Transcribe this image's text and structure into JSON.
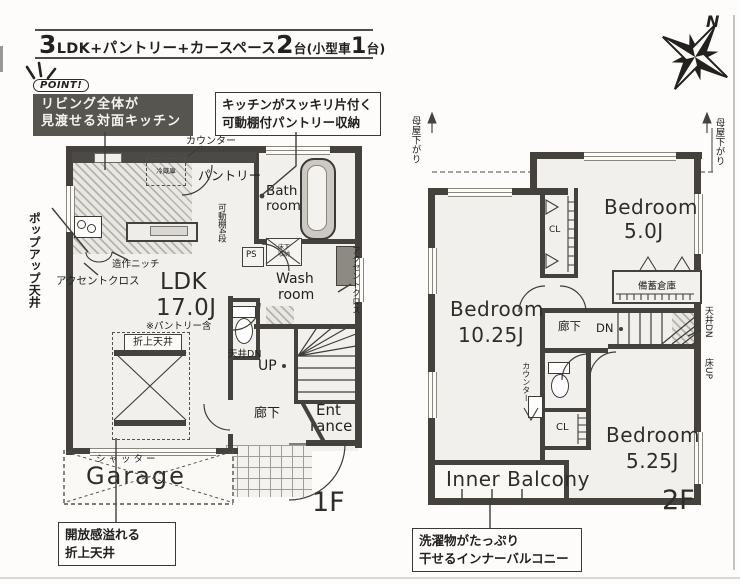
{
  "title": {
    "segments": [
      {
        "t": "3"
      },
      {
        "t": "LDK"
      },
      {
        "t": " +パントリー+カースペース"
      },
      {
        "t": "2"
      },
      {
        "t": "台"
      },
      {
        "t": "(小型車"
      },
      {
        "t": "1"
      },
      {
        "t": "台)"
      }
    ]
  },
  "point": {
    "badge": "POINT!",
    "line1": "リビング全体が",
    "line2": "見渡せる対面キッチン"
  },
  "callouts": {
    "pantry": {
      "line1": "キッチンがスッキリ片付く",
      "line2": "可動棚付パントリー収納"
    },
    "ceiling": {
      "line1": "開放感溢れる",
      "line2": "折上天井"
    },
    "balcony": {
      "line1": "洗濯物がたっぷり",
      "line2": "干せるインナーバルコニー"
    }
  },
  "compass": {
    "north": "N"
  },
  "floor1": {
    "label": "1F",
    "counter": "カウンター",
    "pantry": "パントリー",
    "bath_l1": "Bath",
    "bath_l2": "room",
    "shelf": "可動棚4段",
    "underfloor_l1": "床下",
    "underfloor_l2": "収納",
    "ps": "PS",
    "wash_l1": "Wash",
    "wash_l2": "room",
    "accent_right": "アクセントクロス",
    "popup": "ポップアップ天井",
    "niche": "造作ニッチ",
    "accent_left": "アクセントクロス",
    "ldk": "LDK",
    "ldk_size": "17.0J",
    "ldk_note": "※パントリー含",
    "fridge": "冷蔵庫",
    "orikami": "折上天井",
    "ceiling_dn": "天井DN",
    "up": "UP",
    "hall": "廊下",
    "ent_l1": "Ent",
    "ent_l2": "rance",
    "shutter": "シャッター",
    "garage": "Garage"
  },
  "floor2": {
    "label": "2F",
    "moya_left": "母屋下がり",
    "moya_right": "母屋下がり",
    "b1": "Bedroom",
    "b1_size": "5.0J",
    "cl_top": "CL",
    "storage": "備蓄倉庫",
    "dn": "DN",
    "hall": "廊下",
    "tenjo_dn": "天井DN",
    "yuka_up": "床UP",
    "b2": "Bedroom",
    "b2_size": "10.25J",
    "counter": "カウンター",
    "cl_bottom": "CL",
    "b3": "Bedroom",
    "b3_size": "5.25J",
    "balcony": "Inner Balcony"
  },
  "colors": {
    "wall": "#45423e",
    "point_box_bg": "#57554f",
    "leader": "#3f3d39",
    "hatch": "#b7b4ae"
  }
}
